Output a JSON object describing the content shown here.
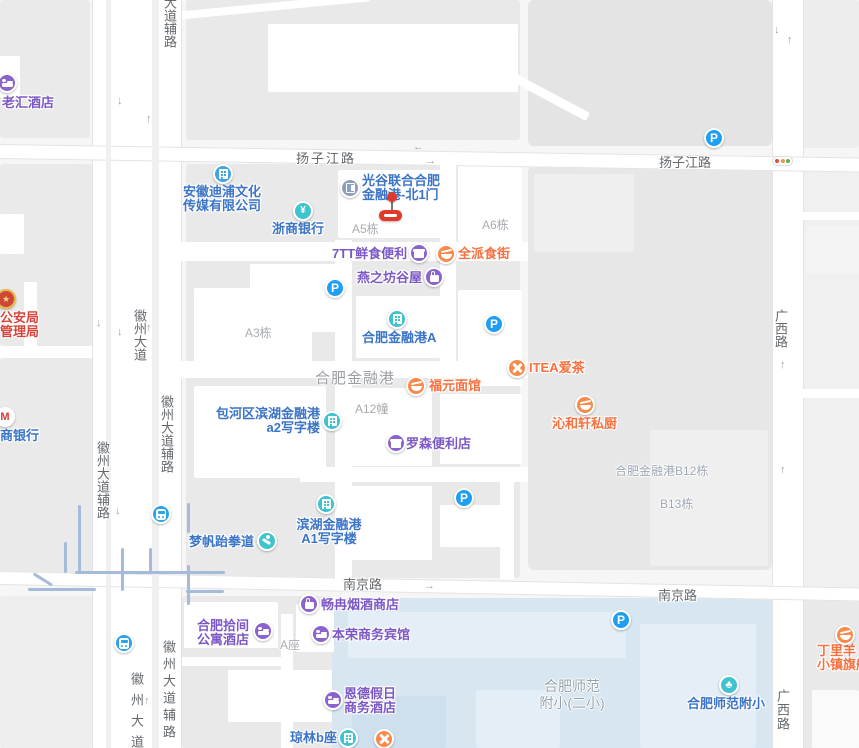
{
  "map": {
    "colors": {
      "poi_purple_text": "#7B58C6",
      "poi_purple_icon": "#8A63CC",
      "poi_blue_text": "#3B74C7",
      "poi_teal_icon": "#3FC3CE",
      "poi_company_icon": "#43A5DE",
      "poi_orange_text": "#F77140",
      "poi_orange_icon": "#FA8A4B",
      "poi_gate_icon": "#8CA0BE",
      "poi_police_text": "#D6453D",
      "parking_blue": "#1F9FF2",
      "metro_blue": "#2BA3E9",
      "marker_red": "#E23A2A",
      "campus_fill": "#D7E6F1",
      "block_fill": "#E9E9E9",
      "road_fill": "#FFFFFF",
      "rail_line": "#A6BADC",
      "traffic_light_dots": [
        "#E54A3F",
        "#F0953F",
        "#5BB054"
      ]
    },
    "glyphs": {
      "parking": "P",
      "yuan": "¥",
      "cmb_m": "M",
      "police_star": "★",
      "school_leaf": "♣",
      "arrow_up": "↑",
      "arrow_down": "↓",
      "arrow_left": "←",
      "arrow_right": "→"
    },
    "road_labels": [
      {
        "text": "扬子江路"
      },
      {
        "text": "扬子江路"
      },
      {
        "text": "南京路"
      },
      {
        "text": "南京路"
      },
      {
        "text": "徽州大道"
      },
      {
        "text": "大道辅路"
      },
      {
        "text": "徽州大道辅路"
      },
      {
        "text": "徽州大道辅路"
      },
      {
        "text": "徽州大道"
      },
      {
        "text": "徽州大道辅路"
      },
      {
        "text": "广西路"
      },
      {
        "text": "广西路"
      }
    ],
    "building_labels": [
      {
        "text": "A5栋"
      },
      {
        "text": "A6栋"
      },
      {
        "text": "A3栋"
      },
      {
        "text": "A12幢"
      },
      {
        "text": "合肥金融港"
      },
      {
        "text": "合肥金融港B12栋"
      },
      {
        "text": "B13栋"
      },
      {
        "text": "A座"
      },
      {
        "lines": [
          "合肥师范",
          "附小(二小)"
        ]
      }
    ],
    "pois": [
      {
        "name": "老汇酒店",
        "category": "hotel"
      },
      {
        "lines": [
          "安徽迪浦文化",
          "传媒有限公司"
        ],
        "category": "company"
      },
      {
        "lines": [
          "光谷联合合肥",
          "金融港-北1门"
        ],
        "category": "gate"
      },
      {
        "name": "浙商银行",
        "category": "bank"
      },
      {
        "name": "7TT鲜食便利",
        "category": "convenience-store"
      },
      {
        "name": "全派食街",
        "category": "food"
      },
      {
        "name": "燕之坊谷屋",
        "category": "shop"
      },
      {
        "name": "合肥金融港A",
        "category": "office-building"
      },
      {
        "name": "ITEA爱茶",
        "category": "restaurant"
      },
      {
        "name": "福元面馆",
        "category": "food"
      },
      {
        "name": "沁和轩私厨",
        "category": "food"
      },
      {
        "lines": [
          "包河区滨湖金融港",
          "a2写字楼"
        ],
        "category": "office-building"
      },
      {
        "name": "罗森便利店",
        "category": "convenience-store"
      },
      {
        "lines": [
          "公安局",
          "管理局"
        ],
        "category": "government"
      },
      {
        "name": "商银行",
        "category": "bank"
      },
      {
        "lines": [
          "滨湖金融港",
          "A1写字楼"
        ],
        "category": "office-building"
      },
      {
        "name": "梦帆跆拳道",
        "category": "sports"
      },
      {
        "name": "畅冉烟酒商店",
        "category": "shop"
      },
      {
        "lines": [
          "合肥拾间",
          "公寓酒店"
        ],
        "category": "hotel"
      },
      {
        "name": "本荣商务宾馆",
        "category": "hotel"
      },
      {
        "lines": [
          "恩德假日",
          "商务酒店"
        ],
        "category": "hotel"
      },
      {
        "name": "琼林b座",
        "category": "office-building"
      },
      {
        "name": "合肥师范附小",
        "category": "school"
      },
      {
        "lines": [
          "丁里羊",
          "小镇旗舰"
        ],
        "category": "food"
      }
    ]
  }
}
